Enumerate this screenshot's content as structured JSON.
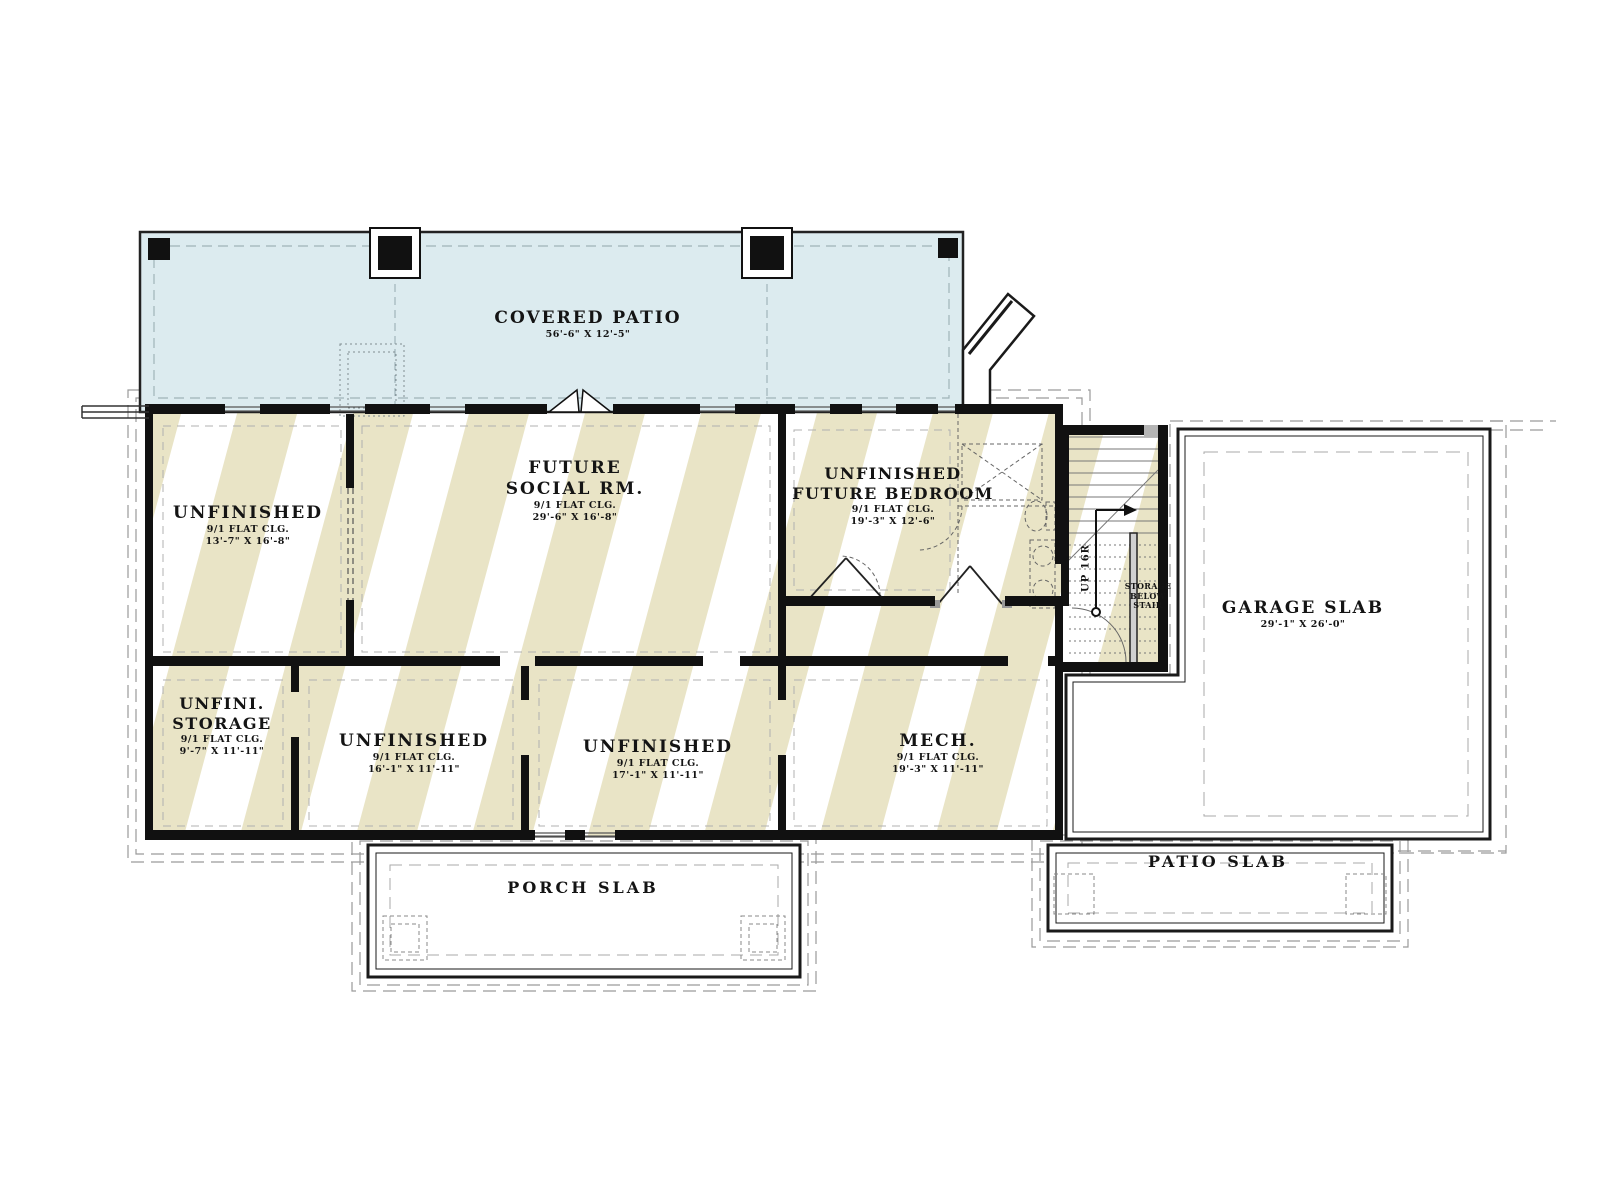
{
  "plan": {
    "level": "basement foundation plan"
  },
  "colors": {
    "hatch_stripe": "#e9e4c6",
    "patio_fill": "#dcebef",
    "wall": "#111111",
    "dashed_line": "#999999"
  },
  "rooms": {
    "covered_patio": {
      "name": "COVERED PATIO",
      "dims": "56'-6\" X 12'-5\""
    },
    "unfinished_nw": {
      "name": "UNFINISHED",
      "clg": "9/1 FLAT CLG.",
      "dims": "13'-7\" X 16'-8\""
    },
    "future_social": {
      "name1": "FUTURE",
      "name2": "SOCIAL RM.",
      "clg": "9/1 FLAT CLG.",
      "dims": "29'-6\" X 16'-8\""
    },
    "future_bedroom": {
      "name1": "UNFINISHED",
      "name2": "FUTURE BEDROOM",
      "clg": "9/1 FLAT CLG.",
      "dims": "19'-3\" X 12'-6\""
    },
    "garage_slab": {
      "name": "GARAGE SLAB",
      "dims": "29'-1\" X 26'-0\""
    },
    "unfin_storage": {
      "name1": "UNFINI.",
      "name2": "STORAGE",
      "clg": "9/1 FLAT CLG.",
      "dims": "9'-7\" X 11'-11\""
    },
    "unfinished_sw": {
      "name": "UNFINISHED",
      "clg": "9/1 FLAT CLG.",
      "dims": "16'-1\" X 11'-11\""
    },
    "unfinished_s": {
      "name": "UNFINISHED",
      "clg": "9/1 FLAT CLG.",
      "dims": "17'-1\" X 11'-11\""
    },
    "mech": {
      "name": "MECH.",
      "clg": "9/1 FLAT CLG.",
      "dims": "19'-3\" X 11'-11\""
    },
    "porch_slab": {
      "name": "PORCH SLAB"
    },
    "patio_slab": {
      "name": "PATIO SLAB"
    }
  },
  "stair": {
    "up_label": "UP 16R",
    "storage1": "STORAGE",
    "storage2": "BELOW",
    "storage3": "STAIR"
  }
}
